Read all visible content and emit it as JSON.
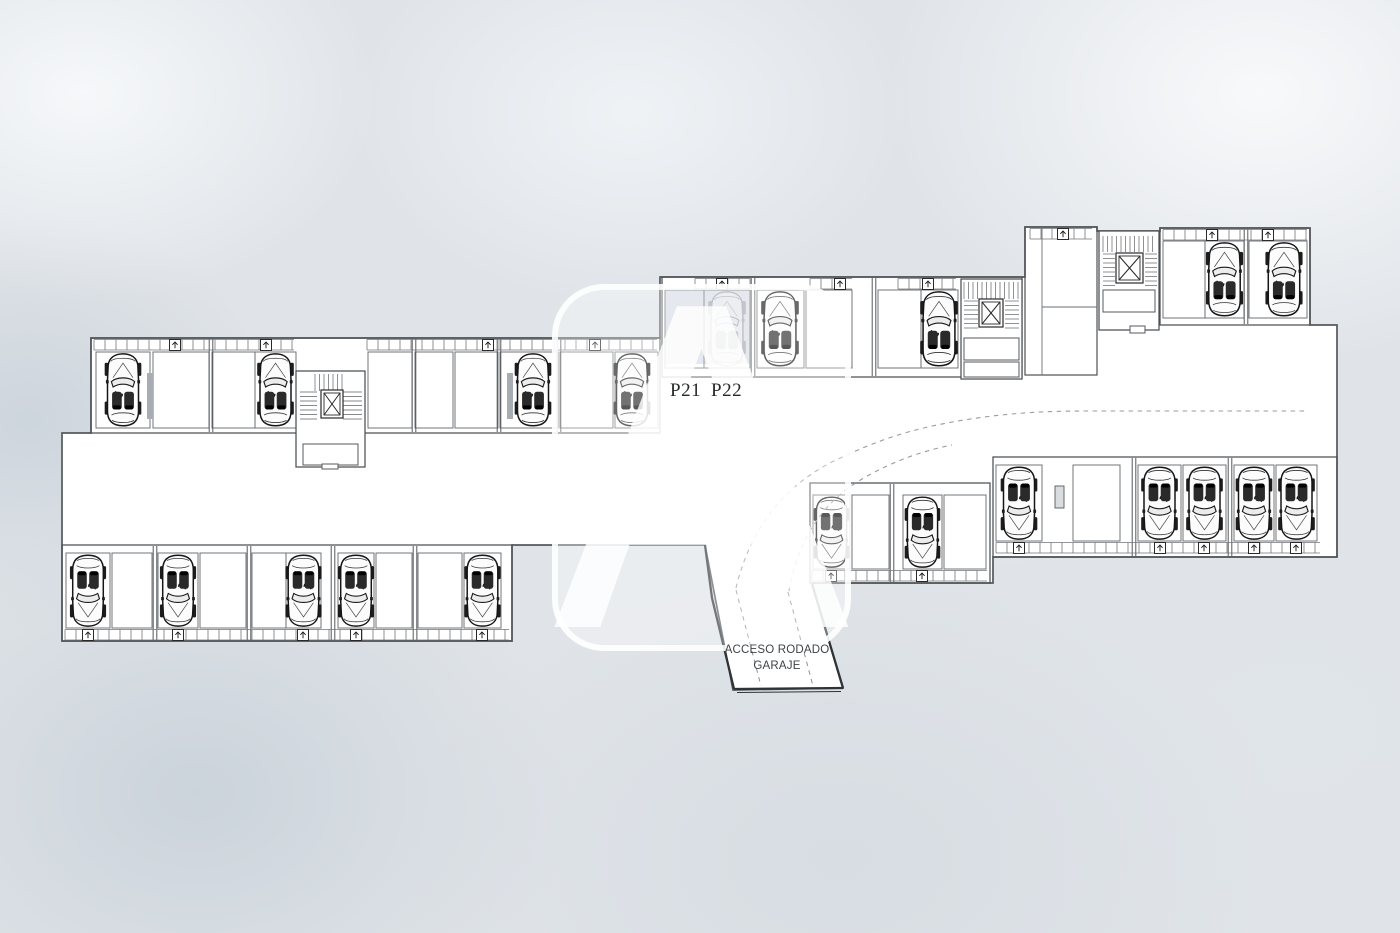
{
  "title": "Planta de garaje",
  "labels": {
    "p21": "P21",
    "p22": "P22",
    "ramp_line1": "ACCESO RODADO",
    "ramp_line2": "GARAJE",
    "watermark": "A"
  },
  "colors": {
    "background": "#e0e4e8",
    "floor": "#ffffff",
    "wall": "#55595d",
    "wall_dark": "#2e3338",
    "strip": "#4c5154",
    "cell": "#6a6f73",
    "band": "#70757a",
    "car_ink": "#161616",
    "highlight": "#c6cfdb",
    "pillar": "#a7adb3",
    "dash": "#979da2"
  },
  "plan": {
    "silhouette": "M 91,338 L 660,338 L 660,277 L 1025,277 L 1025,227 L 1097,227 L 1097,231 L 1160,231 L 1160,228 L 1310,228 L 1310,325 L 1337,325 L 1337,557 L 993,557 L 993,583 L 812,583 L 843,688 L 733,690 L 705,545 L 512,545 L 512,641 L 62,641 L 62,433 L 91,433 Z",
    "strips": [
      {
        "id": "upper-left",
        "orient": "up",
        "rect": [
          91,
          338,
          569,
          95
        ],
        "cell_y": [
          352,
          428
        ],
        "band": {
          "y": 339,
          "segments": [
            [
              94,
              294
            ],
            [
              367,
              657
            ]
          ],
          "arrows": [
            175,
            266,
            488,
            595
          ]
        },
        "walls": [
          211,
          414,
          499,
          559
        ],
        "pillars": [
          [
            147,
            373,
            6,
            46
          ],
          [
            507,
            373,
            6,
            46
          ]
        ],
        "cells": [
          {
            "x": [
              96,
              150
            ],
            "car": true
          },
          {
            "x": [
              153,
              209
            ]
          },
          {
            "x": [
              212,
              255
            ]
          },
          {
            "x": [
              255,
              296
            ],
            "car": true
          },
          {
            "x": [
              368,
              412
            ]
          },
          {
            "x": [
              415,
              453
            ]
          },
          {
            "x": [
              455,
              498
            ]
          },
          {
            "x": [
              500,
              558
            ],
            "car": true,
            "car_cx": 533
          },
          {
            "x": [
              560,
              613
            ]
          },
          {
            "x": [
              615,
              658
            ],
            "car": true,
            "car_cx": 632
          }
        ]
      },
      {
        "id": "lower-left",
        "orient": "down",
        "rect": [
          62,
          545,
          450,
          96
        ],
        "cell_y": [
          553,
          628
        ],
        "band": {
          "y": 629,
          "segments": [
            [
              65,
              509
            ]
          ],
          "arrows": [
            88,
            178,
            303,
            356,
            482
          ]
        },
        "walls": [
          155,
          249,
          333,
          415
        ],
        "pillars": [],
        "cells": [
          {
            "x": [
              66,
              110
            ],
            "car": true
          },
          {
            "x": [
              112,
              152
            ]
          },
          {
            "x": [
              158,
              198
            ],
            "car": true
          },
          {
            "x": [
              200,
              246
            ]
          },
          {
            "x": [
              252,
              286
            ]
          },
          {
            "x": [
              286,
              321
            ],
            "car": true
          },
          {
            "x": [
              338,
              374
            ],
            "car": true
          },
          {
            "x": [
              376,
              412
            ]
          },
          {
            "x": [
              418,
              462
            ]
          },
          {
            "x": [
              464,
              501
            ],
            "car": true
          }
        ]
      },
      {
        "id": "upper-middle",
        "orient": "up",
        "rect": [
          662,
          277,
          360,
          100
        ],
        "cell_y": [
          290,
          368
        ],
        "band": {
          "y": 278,
          "segments": [
            [
              695,
              750
            ],
            [
              810,
              852
            ],
            [
              898,
              956
            ]
          ],
          "arrows": [
            722,
            840,
            928
          ]
        },
        "walls": [
          753,
          874
        ],
        "pillars": [],
        "highlight_rect": [
          665,
          288,
          85,
          76
        ],
        "cells": [
          {
            "x": [
              665,
              704
            ],
            "highlight": true
          },
          {
            "x": [
              704,
              750
            ],
            "car": true,
            "faint": true,
            "highlight": true
          },
          {
            "x": [
              757,
              804
            ],
            "car": true,
            "car_cx": 780
          },
          {
            "x": [
              806,
              852
            ]
          },
          {
            "x": [
              878,
              921
            ]
          },
          {
            "x": [
              921,
              958
            ],
            "car": true,
            "car_cx": 939
          }
        ]
      },
      {
        "id": "upper-right",
        "orient": "up",
        "rect": [
          1160,
          228,
          150,
          97
        ],
        "cell_y": [
          241,
          318
        ],
        "band": {
          "y": 229,
          "segments": [
            [
              1163,
              1307
            ]
          ],
          "arrows": [
            1212,
            1268
          ]
        },
        "walls": [
          1246
        ],
        "pillars": [],
        "cells": [
          {
            "x": [
              1163,
              1205
            ]
          },
          {
            "x": [
              1205,
              1244
            ],
            "car": true
          },
          {
            "x": [
              1249,
              1307
            ],
            "car": true,
            "car_cx": 1284
          }
        ]
      },
      {
        "id": "lower-right",
        "orient": "down",
        "rect": [
          993,
          457,
          344,
          100
        ],
        "cell_y": [
          465,
          541
        ],
        "band": {
          "y": 542,
          "segments": [
            [
              996,
              1320
            ]
          ],
          "arrows": [
            1019,
            1160,
            1204,
            1254,
            1296
          ]
        },
        "walls": [
          1134,
          1230
        ],
        "pillars": [],
        "door": [
          1055,
          486,
          9,
          22
        ],
        "cells": [
          {
            "x": [
              996,
              1042
            ],
            "car": true,
            "car_cx": 1019
          },
          {
            "x": [
              1073,
              1120
            ]
          },
          {
            "x": [
              1138,
              1181
            ],
            "car": true
          },
          {
            "x": [
              1183,
              1226
            ],
            "car": true
          },
          {
            "x": [
              1234,
              1274
            ],
            "car": true
          },
          {
            "x": [
              1276,
              1317
            ],
            "car": true
          }
        ]
      },
      {
        "id": "lower-middle",
        "orient": "down",
        "rect": [
          810,
          483,
          180,
          100
        ],
        "cell_y": [
          495,
          569
        ],
        "band": {
          "y": 570,
          "segments": [
            [
              812,
              987
            ]
          ],
          "arrows": [
            831,
            922
          ]
        },
        "walls": [
          892
        ],
        "pillars": [],
        "cells": [
          {
            "x": [
              813,
              850
            ],
            "car": true
          },
          {
            "x": [
              852,
              889
            ]
          },
          {
            "x": [
              903,
              942
            ],
            "car": true
          },
          {
            "x": [
              944,
              986
            ]
          }
        ]
      }
    ],
    "stairwells": [
      {
        "id": "stairwell-left",
        "box": [
          296,
          371,
          69,
          96
        ],
        "treads": [
          {
            "r": [
              315,
              374,
              30,
              17
            ],
            "dir": "v"
          },
          {
            "r": [
              300,
              392,
              17,
              30
            ],
            "dir": "h"
          },
          {
            "r": [
              343,
              392,
              19,
              30
            ],
            "dir": "h"
          }
        ],
        "elevator": [
          321,
          390,
          22,
          28
        ],
        "subs": [
          [
            303,
            444,
            55,
            21
          ],
          [
            322,
            464,
            16,
            5
          ]
        ]
      },
      {
        "id": "stairwell-middle",
        "box": [
          961,
          279,
          61,
          100
        ],
        "treads": [
          {
            "r": [
              964,
              282,
              55,
              17
            ],
            "dir": "v"
          },
          {
            "r": [
              964,
              301,
              14,
              27
            ],
            "dir": "h"
          },
          {
            "r": [
              1005,
              301,
              14,
              27
            ],
            "dir": "h"
          }
        ],
        "elevator": [
          979,
          299,
          24,
          28
        ],
        "subs": [
          [
            964,
            338,
            55,
            22
          ],
          [
            964,
            362,
            55,
            15
          ]
        ]
      },
      {
        "id": "stairwell-right",
        "box": [
          1099,
          231,
          60,
          99
        ],
        "treads": [
          {
            "r": [
              1103,
              236,
              52,
              16
            ],
            "dir": "v"
          },
          {
            "r": [
              1103,
              254,
              12,
              32
            ],
            "dir": "h"
          },
          {
            "r": [
              1145,
              254,
              12,
              32
            ],
            "dir": "h"
          }
        ],
        "elevator": [
          1116,
          253,
          27,
          30
        ],
        "subs": [
          [
            1103,
            290,
            52,
            22
          ],
          [
            1130,
            326,
            15,
            7
          ]
        ]
      }
    ],
    "rooms": [
      {
        "rect": [
          1025,
          227,
          72,
          148
        ],
        "vlines": [
          [
            1042,
            227,
            1042,
            375
          ]
        ],
        "hlines": [
          [
            1042,
            307,
            1097,
            307
          ]
        ]
      }
    ],
    "lines": [
      [
        1158,
        325,
        1310,
        325
      ],
      [
        1101,
        328,
        1158,
        328
      ]
    ],
    "bands_extra": [
      {
        "y": 228,
        "segments": [
          [
            1030,
            1092
          ]
        ],
        "arrows": [
          1063
        ]
      }
    ],
    "ramp": {
      "left_edge": "M 705,545 L 712,598 L 734,689",
      "right_edge": "M 812,584 L 843,688",
      "bottom_edge": "M 734,689 L 843,688",
      "bottom_edge2": "M 737,692.5 L 841,691.5",
      "lanes": [
        [
          736,
          590,
          761,
          686
        ],
        [
          788,
          592,
          813,
          686
        ]
      ]
    },
    "drive_paths": [
      "M 736,588 C 748,538 775,492 830,463 C 882,437 918,428 958,421 C 1005,413 1045,411 1085,411 L 1305,411",
      "M 789,591 C 797,545 818,505 862,479 C 893,461 922,451 952,445"
    ]
  }
}
